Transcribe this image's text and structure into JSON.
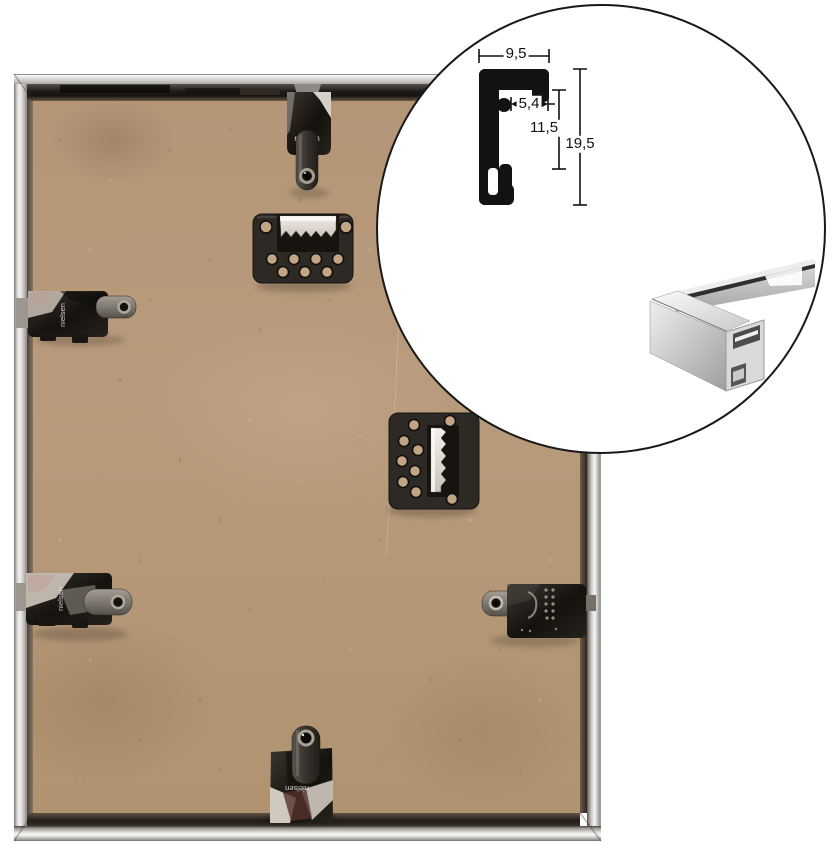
{
  "inset": {
    "dimensions": {
      "face_width": "9,5",
      "rebate": "5,4",
      "inner_depth": "11,5",
      "total_depth": "19,5"
    }
  },
  "hardware": {
    "brand": "nielsen"
  },
  "colors": {
    "background": "#ffffff",
    "board_tan": "#b69878",
    "frame_silver": "#d9d8d6",
    "hardware_black": "#1b1815",
    "diagram_ink": "#121212"
  }
}
